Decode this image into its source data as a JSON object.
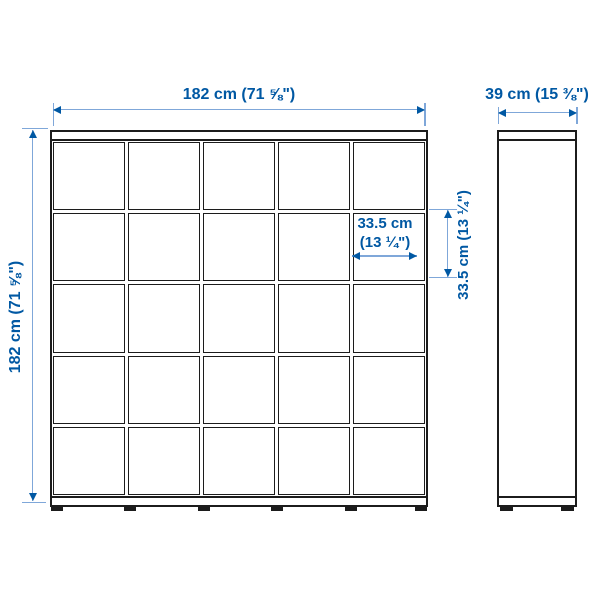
{
  "diagram": {
    "type": "furniture-dimension-drawing",
    "views": {
      "front": "5x5 cube shelving unit, front elevation",
      "side": "shelving unit, side elevation"
    },
    "grid": {
      "rows": 5,
      "columns": 5
    },
    "dimensions": {
      "front_width": "182 cm (71 ⅝\")",
      "front_height": "182 cm (71 ⅝\")",
      "side_depth": "39 cm (15 ⅜\")",
      "cell_width_line1": "33.5 cm",
      "cell_width_line2": "(13 ¼\")",
      "cell_height": "33.5 cm (13 ¼\")"
    },
    "colors": {
      "dimension_text": "#0058a3",
      "dimension_line": "#7fa7d9",
      "outline": "#1c1c1c",
      "background": "#ffffff"
    }
  }
}
